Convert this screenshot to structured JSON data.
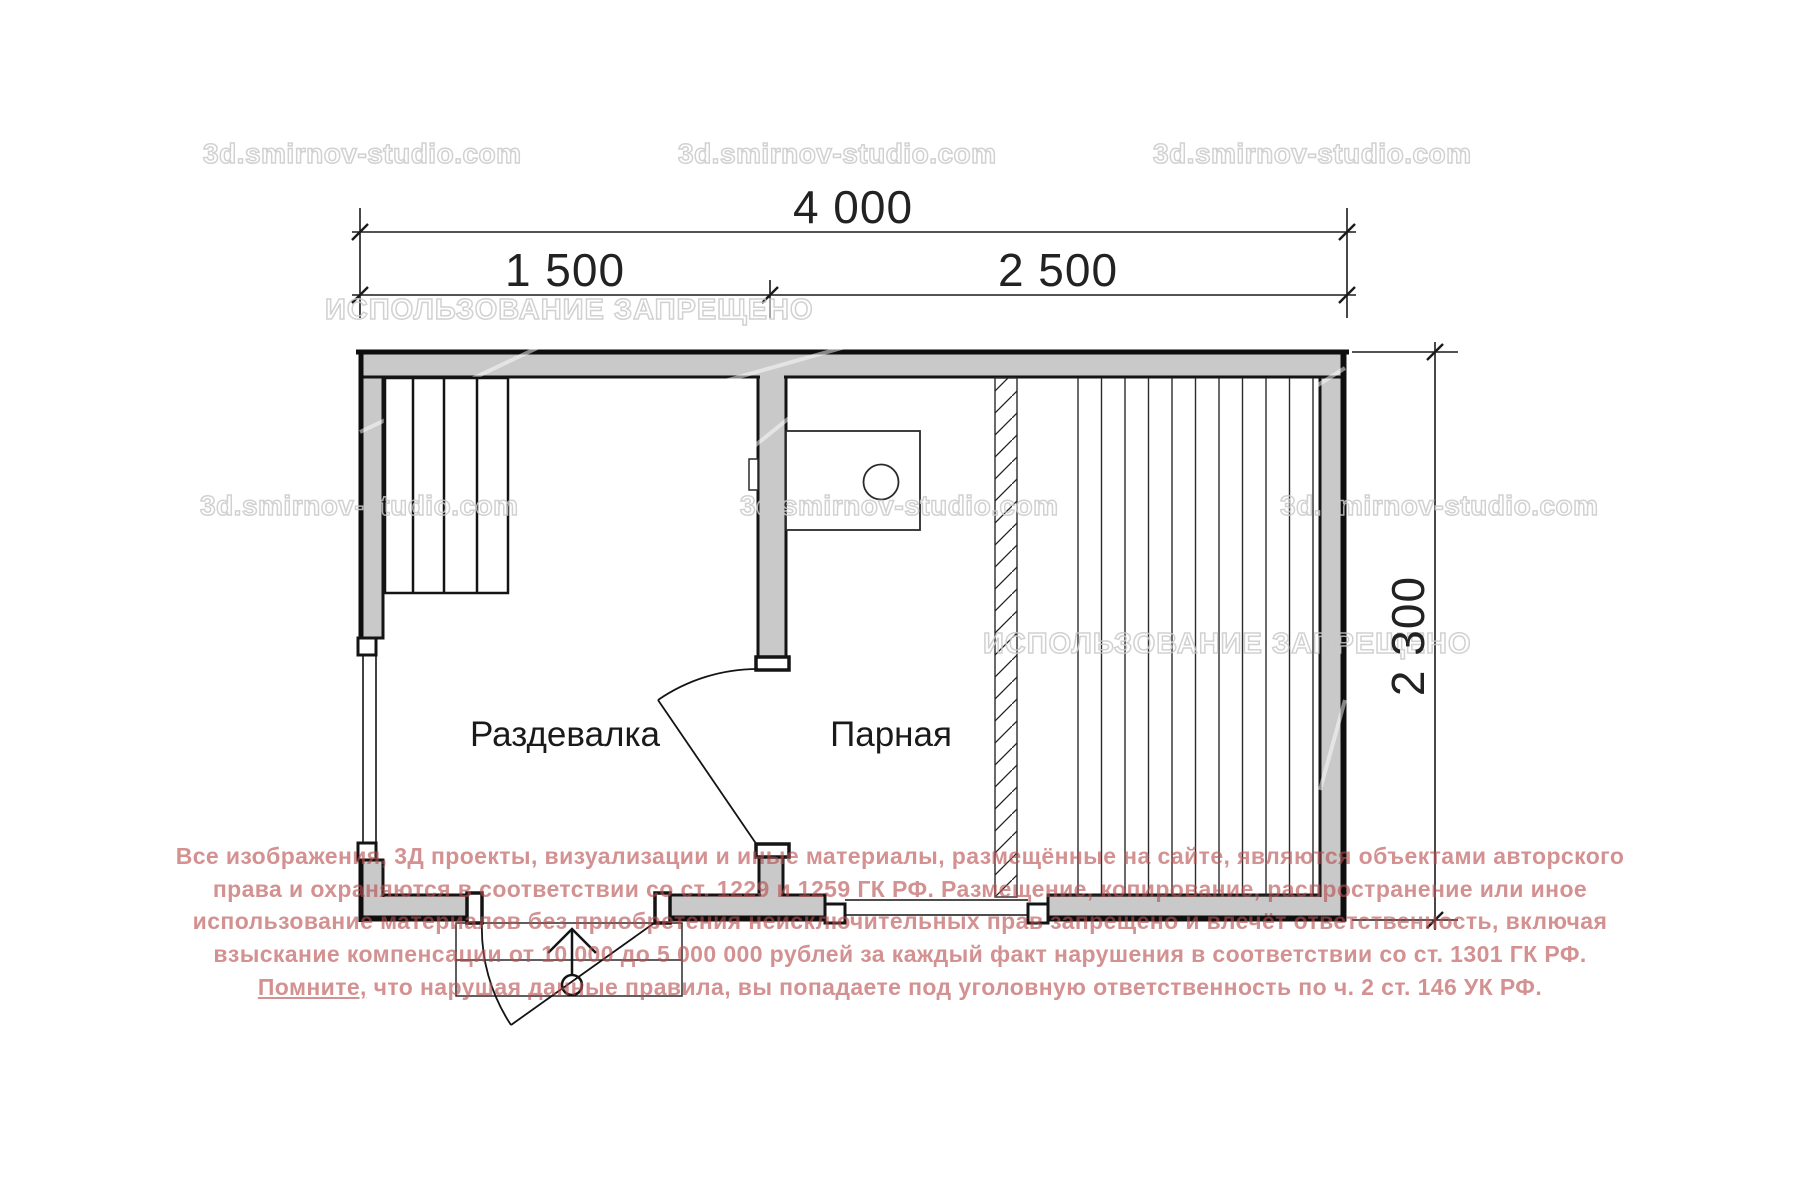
{
  "watermarks": {
    "site": "3d.smirnov-studio.com",
    "forbidden": "ИСПОЛЬЗОВАНИЕ ЗАПРЕЩЕНО"
  },
  "plan": {
    "rooms": [
      {
        "label": "Раздевалка"
      },
      {
        "label": "Парная"
      }
    ],
    "dimensions": {
      "total_width": "4 000",
      "left_section": "1 500",
      "right_section": "2 500",
      "depth": "2 300"
    }
  },
  "legal": {
    "lines": [
      "Все изображения, 3Д проекты, визуализации и иные материалы, размещённые на сайте, являются объектами авторского",
      "права и охраняются в соответствии со ст. 1229 и 1259 ГК РФ. Размещение, копирование, распространение или иное",
      "использование материалов без приобретения неисключительных прав запрещено и влечёт ответственность, включая",
      "взыскание компенсации от 10 000 до 5 000 000 рублей за каждый факт нарушения в соответствии со ст. 1301 ГК РФ."
    ],
    "line5": {
      "underlined": "Помните,",
      "rest": " что нарушая данные правила, вы попадаете под уголовную ответственность по ч. 2 ст. 146 УК РФ."
    }
  },
  "colors": {
    "wall_fill": "#c9c9c9",
    "line": "#141414",
    "legal_text": "#b84d4d",
    "watermark_outline": "#c9c9c9"
  }
}
